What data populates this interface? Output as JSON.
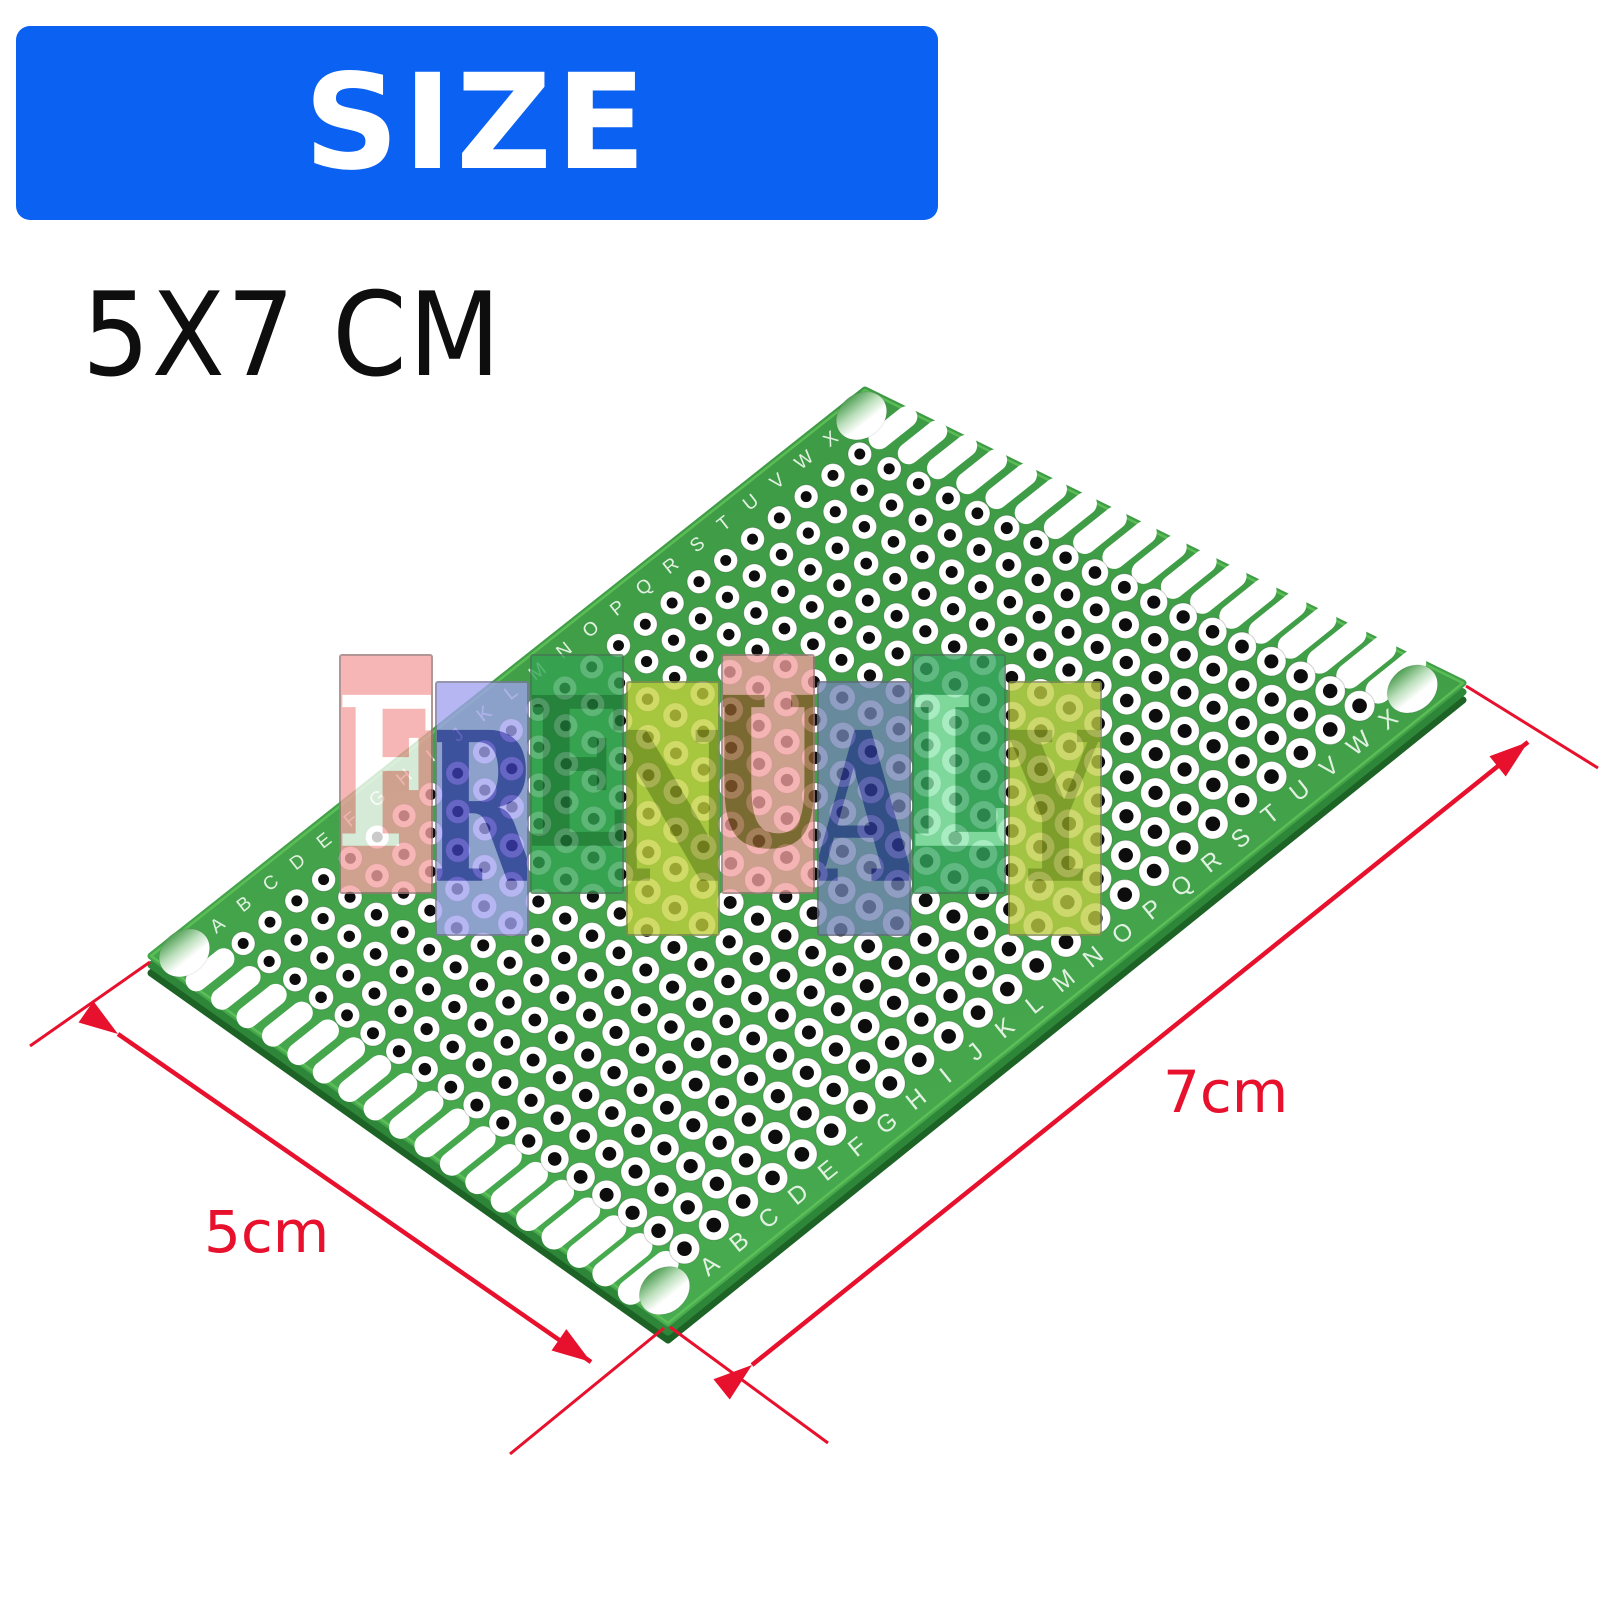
{
  "banner": {
    "label": "SIZE",
    "bg": "#0B61F2",
    "fg": "#FFFFFF"
  },
  "size_label": "5X7 CM",
  "watermark": {
    "text": "FRENUALY",
    "opacity": 0.78,
    "tiles": [
      {
        "char": "F",
        "bg": "#F5A2A2",
        "fg": "#FFFFFF",
        "lift": true
      },
      {
        "char": "R",
        "bg": "#A2A2EF",
        "fg": "#3C3CB4",
        "lift": false
      },
      {
        "char": "E",
        "bg": "#33A452",
        "fg": "#1E7C38",
        "lift": true
      },
      {
        "char": "N",
        "bg": "#C2D23C",
        "fg": "#8C9C20",
        "lift": false
      },
      {
        "char": "U",
        "bg": "#F2A0A0",
        "fg": "#8A5C2C",
        "lift": true
      },
      {
        "char": "A",
        "bg": "#7284B4",
        "fg": "#2E3A96",
        "lift": false
      },
      {
        "char": "L",
        "bg": "#35A660",
        "fg": "#90E8B2",
        "lift": true
      },
      {
        "char": "Y",
        "bg": "#BECE42",
        "fg": "#8E9E22",
        "lift": false
      }
    ]
  },
  "board": {
    "rows": 18,
    "cols": 24,
    "column_letters": "ABCDEFGHIJKLMNOPQRSTUVWX",
    "face_color_top": "#3E9A45",
    "face_color_bottom": "#48AB4F",
    "bevel_color": "#2E8639",
    "edge_color": "#1D6326",
    "rim_color": "#5FC258",
    "hole_ring": "#FFFFFF",
    "hole_center": "#0D0D0D",
    "label_color": "#EAF6EA"
  },
  "dimensions": {
    "width_label": "5cm",
    "length_label": "7cm",
    "color": "#E8112D"
  }
}
